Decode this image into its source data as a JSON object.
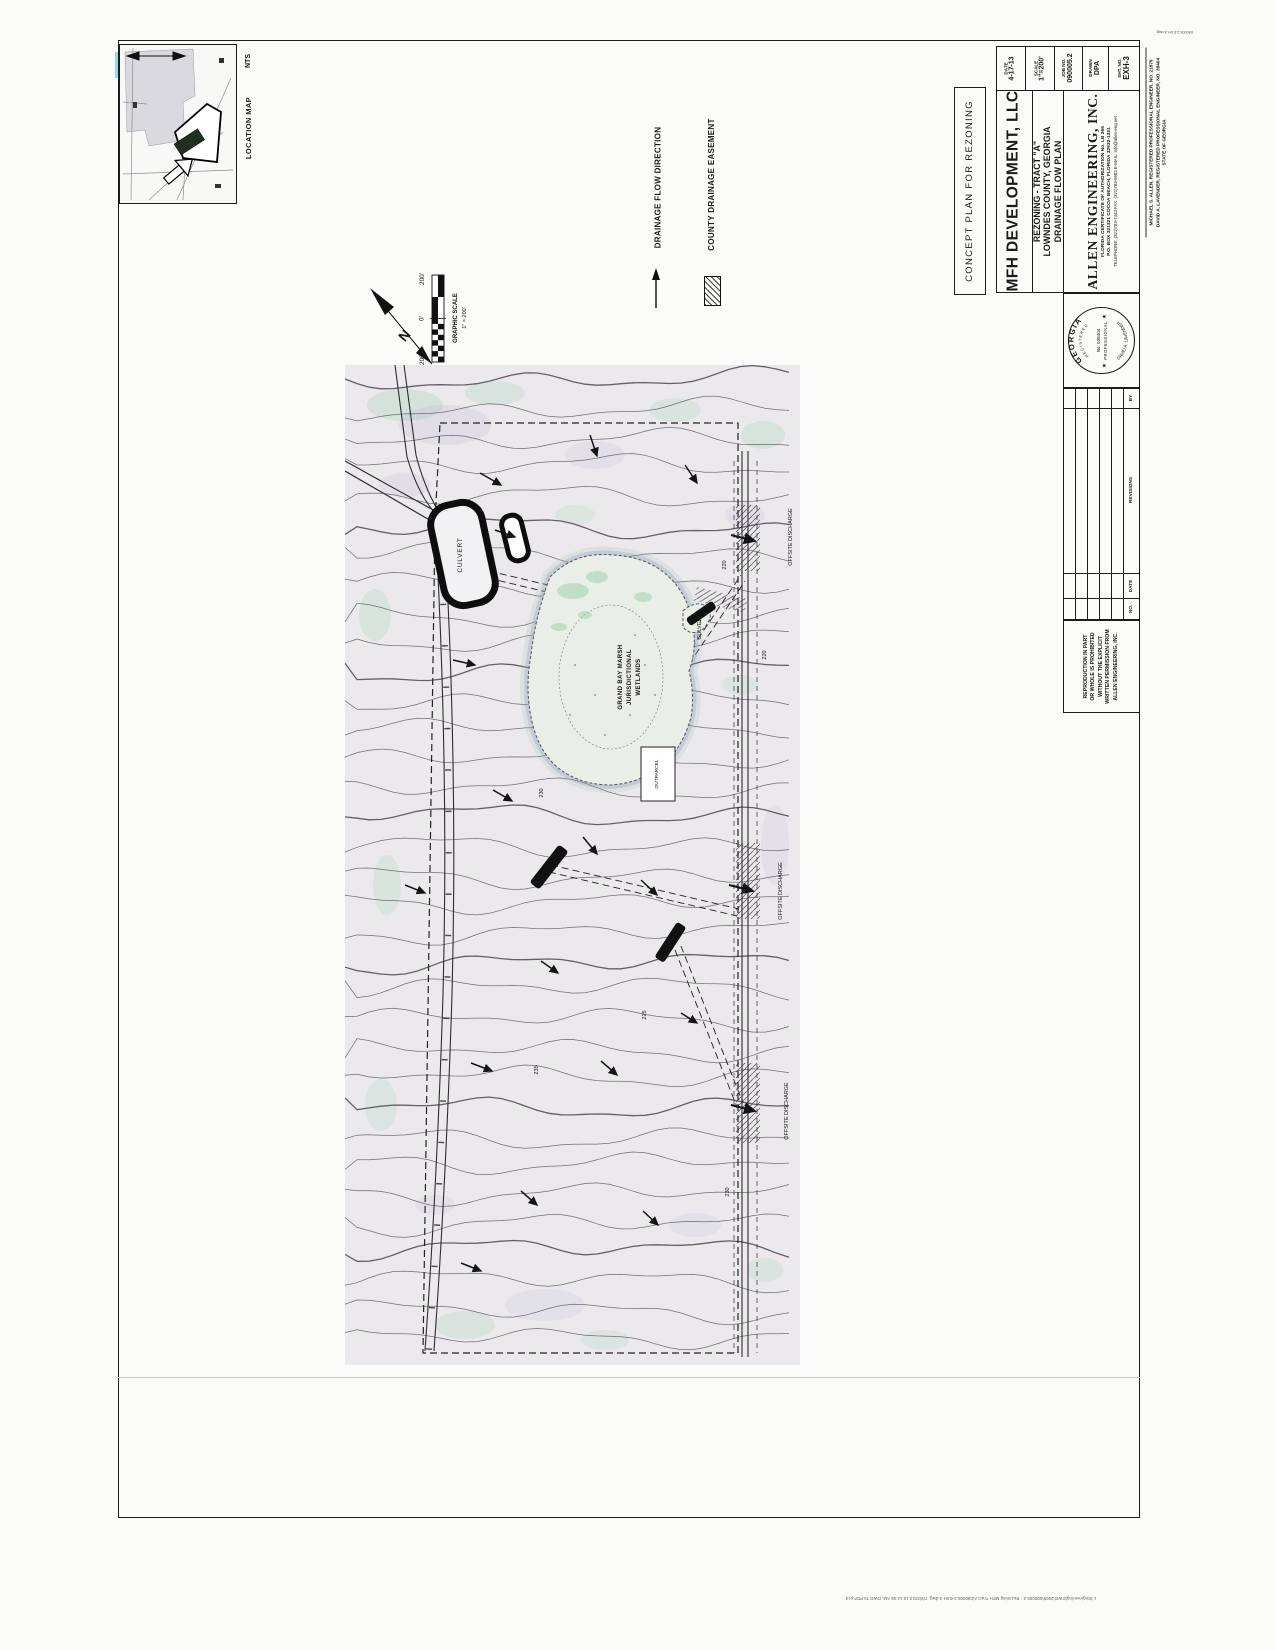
{
  "page": {
    "footer_stamp": "L:\\Engineering\\DWG\\2009\\090005.2 - Rezoning MFH Tract A\\090005.2-EXH-3.dwg, 7/8/2013 10:14:05 AM, DWG To PDF.pc3",
    "dwg_ref": "090005.2-EXH-3.dwg"
  },
  "colors": {
    "ink": "#1c1c1c",
    "paper": "#fbfbfa",
    "map_tint": "#ebe9ec",
    "wetland_fill": "#e9efe7",
    "moss_green": "#8fcfa6",
    "scan_purple": "#b3a8d4",
    "cyan_streak": "#86d2ea"
  },
  "location_map": {
    "title": "LOCATION MAP",
    "scale": "NTS"
  },
  "legend": {
    "items": [
      {
        "label": "DRAINAGE FLOW DIRECTION",
        "symbol": "flow-arrow"
      },
      {
        "label": "COUNTY DRAINAGE EASEMENT",
        "symbol": "hatch-swatch"
      }
    ]
  },
  "north_arrow": {
    "label": "N"
  },
  "graphic_scale": {
    "title": "GRAPHIC SCALE",
    "ratio": "1\" = 200'",
    "labels": [
      "200'",
      "0'",
      "200'"
    ]
  },
  "stamp_box": {
    "label": "CONCEPT PLAN FOR REZONING"
  },
  "title_block": {
    "client": "MFH DEVELOPMENT, LLC",
    "project": [
      "REZONING - TRACT \"A\"",
      "LOWNDES COUNTY, GEORGIA",
      "DRAINAGE FLOW PLAN"
    ],
    "firm": {
      "name": "ALLEN ENGINEERING, INC.",
      "cert": "FLORIDA CERTIFICATE OF AUTHORIZATION No. LB 266",
      "address": "P.O. BOX 321321 COCOA BEACH, FLORIDA 32932-1321",
      "phone": "TELEPHONE: (321)783-7443   FAX: (321)783-5902   E-MAIL: info@allen-eng.net"
    },
    "fields": [
      {
        "label": "DATE",
        "value": "4-17-13"
      },
      {
        "label": "SCALE",
        "value": "1\"=200'"
      },
      {
        "label": "JOB NO.",
        "value": "090005.2"
      },
      {
        "label": "DRAWN",
        "value": "DPA"
      },
      {
        "label": "SHT. NO.",
        "value": "EXH-3"
      }
    ],
    "engineers": [
      "MICHAEL S. ALLEN, REGISTERED PROFESSIONAL ENGINEER, NO. 21879",
      "DAVID A. LAVENDER, REGISTERED PROFESSIONAL ENGINEER, NO. 38404",
      "STATE OF GEORGIA"
    ],
    "seal": {
      "state": "GEORGIA",
      "registered": "REGISTERED",
      "number": "No. 038404",
      "profession": "PROFESSIONAL",
      "name": "DAVID A. LAVENDER",
      "star": "★"
    },
    "revisions": {
      "headers": [
        "NO.",
        "DATE",
        "REVISIONS",
        "BY"
      ]
    },
    "reproduction_note": [
      "REPRODUCTION IN PART",
      "OR WHOLE IS PROHIBITED",
      "WITHOUT THE EXPLICIT",
      "WRITTEN PERMISSION FROM",
      "ALLEN ENGINEERING, INC."
    ]
  },
  "map": {
    "labels": [
      {
        "text": "CULVERT"
      },
      {
        "text": "CULVERT"
      },
      {
        "text": "GRAND BAY MARSH"
      },
      {
        "text": "JURISDICTIONAL"
      },
      {
        "text": "WETLANDS"
      },
      {
        "text": "OFFSITE DISCHARGE"
      },
      {
        "text": "OFFSITE DISCHARGE"
      },
      {
        "text": "OFFSITE DISCHARGE"
      },
      {
        "text": "OUTPARCEL"
      },
      {
        "text": "220"
      },
      {
        "text": "230"
      },
      {
        "text": "225"
      },
      {
        "text": "235"
      },
      {
        "text": "230"
      },
      {
        "text": "220"
      }
    ]
  }
}
